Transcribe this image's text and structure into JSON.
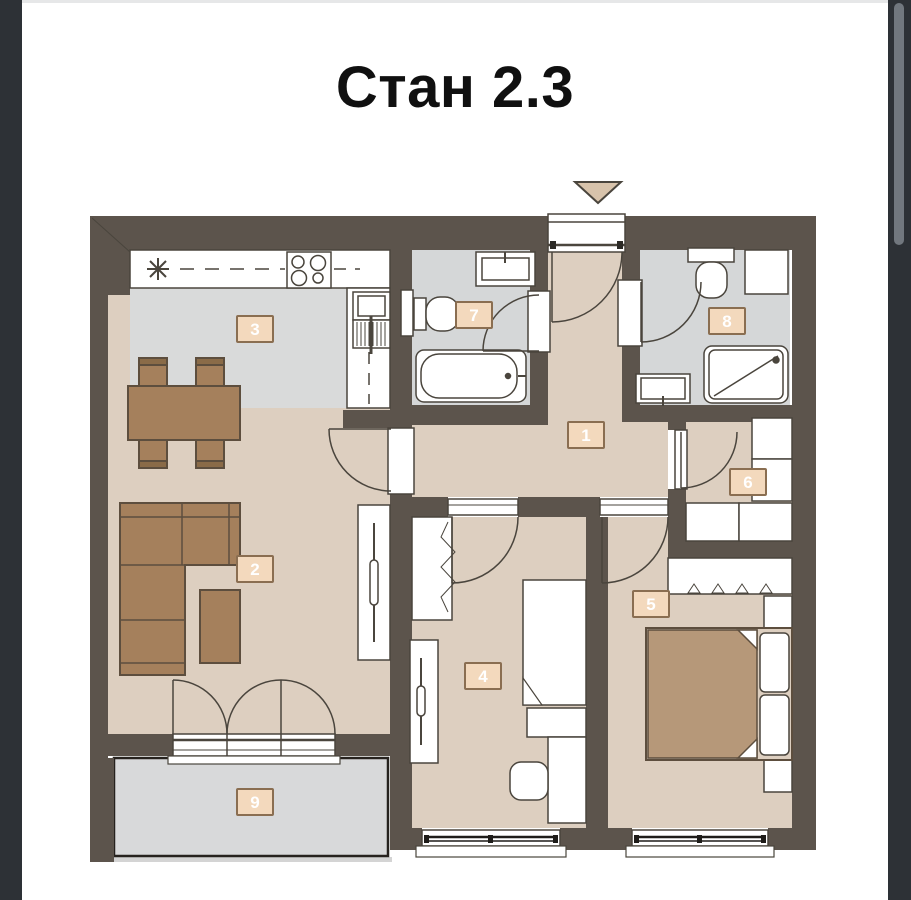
{
  "title": "Стан 2.3",
  "rooms": [
    {
      "number": "1"
    },
    {
      "number": "2"
    },
    {
      "number": "3"
    },
    {
      "number": "4"
    },
    {
      "number": "5"
    },
    {
      "number": "6"
    },
    {
      "number": "7"
    },
    {
      "number": "8"
    },
    {
      "number": "9"
    }
  ],
  "colors": {
    "wall": "#5c544c",
    "floor_beige": "#ddcfc0",
    "kitchen_floor": "#d9dada",
    "bath_floor": "#d5d7d8",
    "terrace_floor": "#d8d9da",
    "furniture_brown": "#a5805c",
    "bed_blanket": "#b69879",
    "label_background": "#f3d9bd",
    "label_border": "#8a6e51",
    "line_outline": "#4a453d",
    "side_rail": "#2d3136",
    "scrollbar": "#71777e",
    "entrance_marker": "#d8c3ab",
    "title_text": "#101010"
  }
}
